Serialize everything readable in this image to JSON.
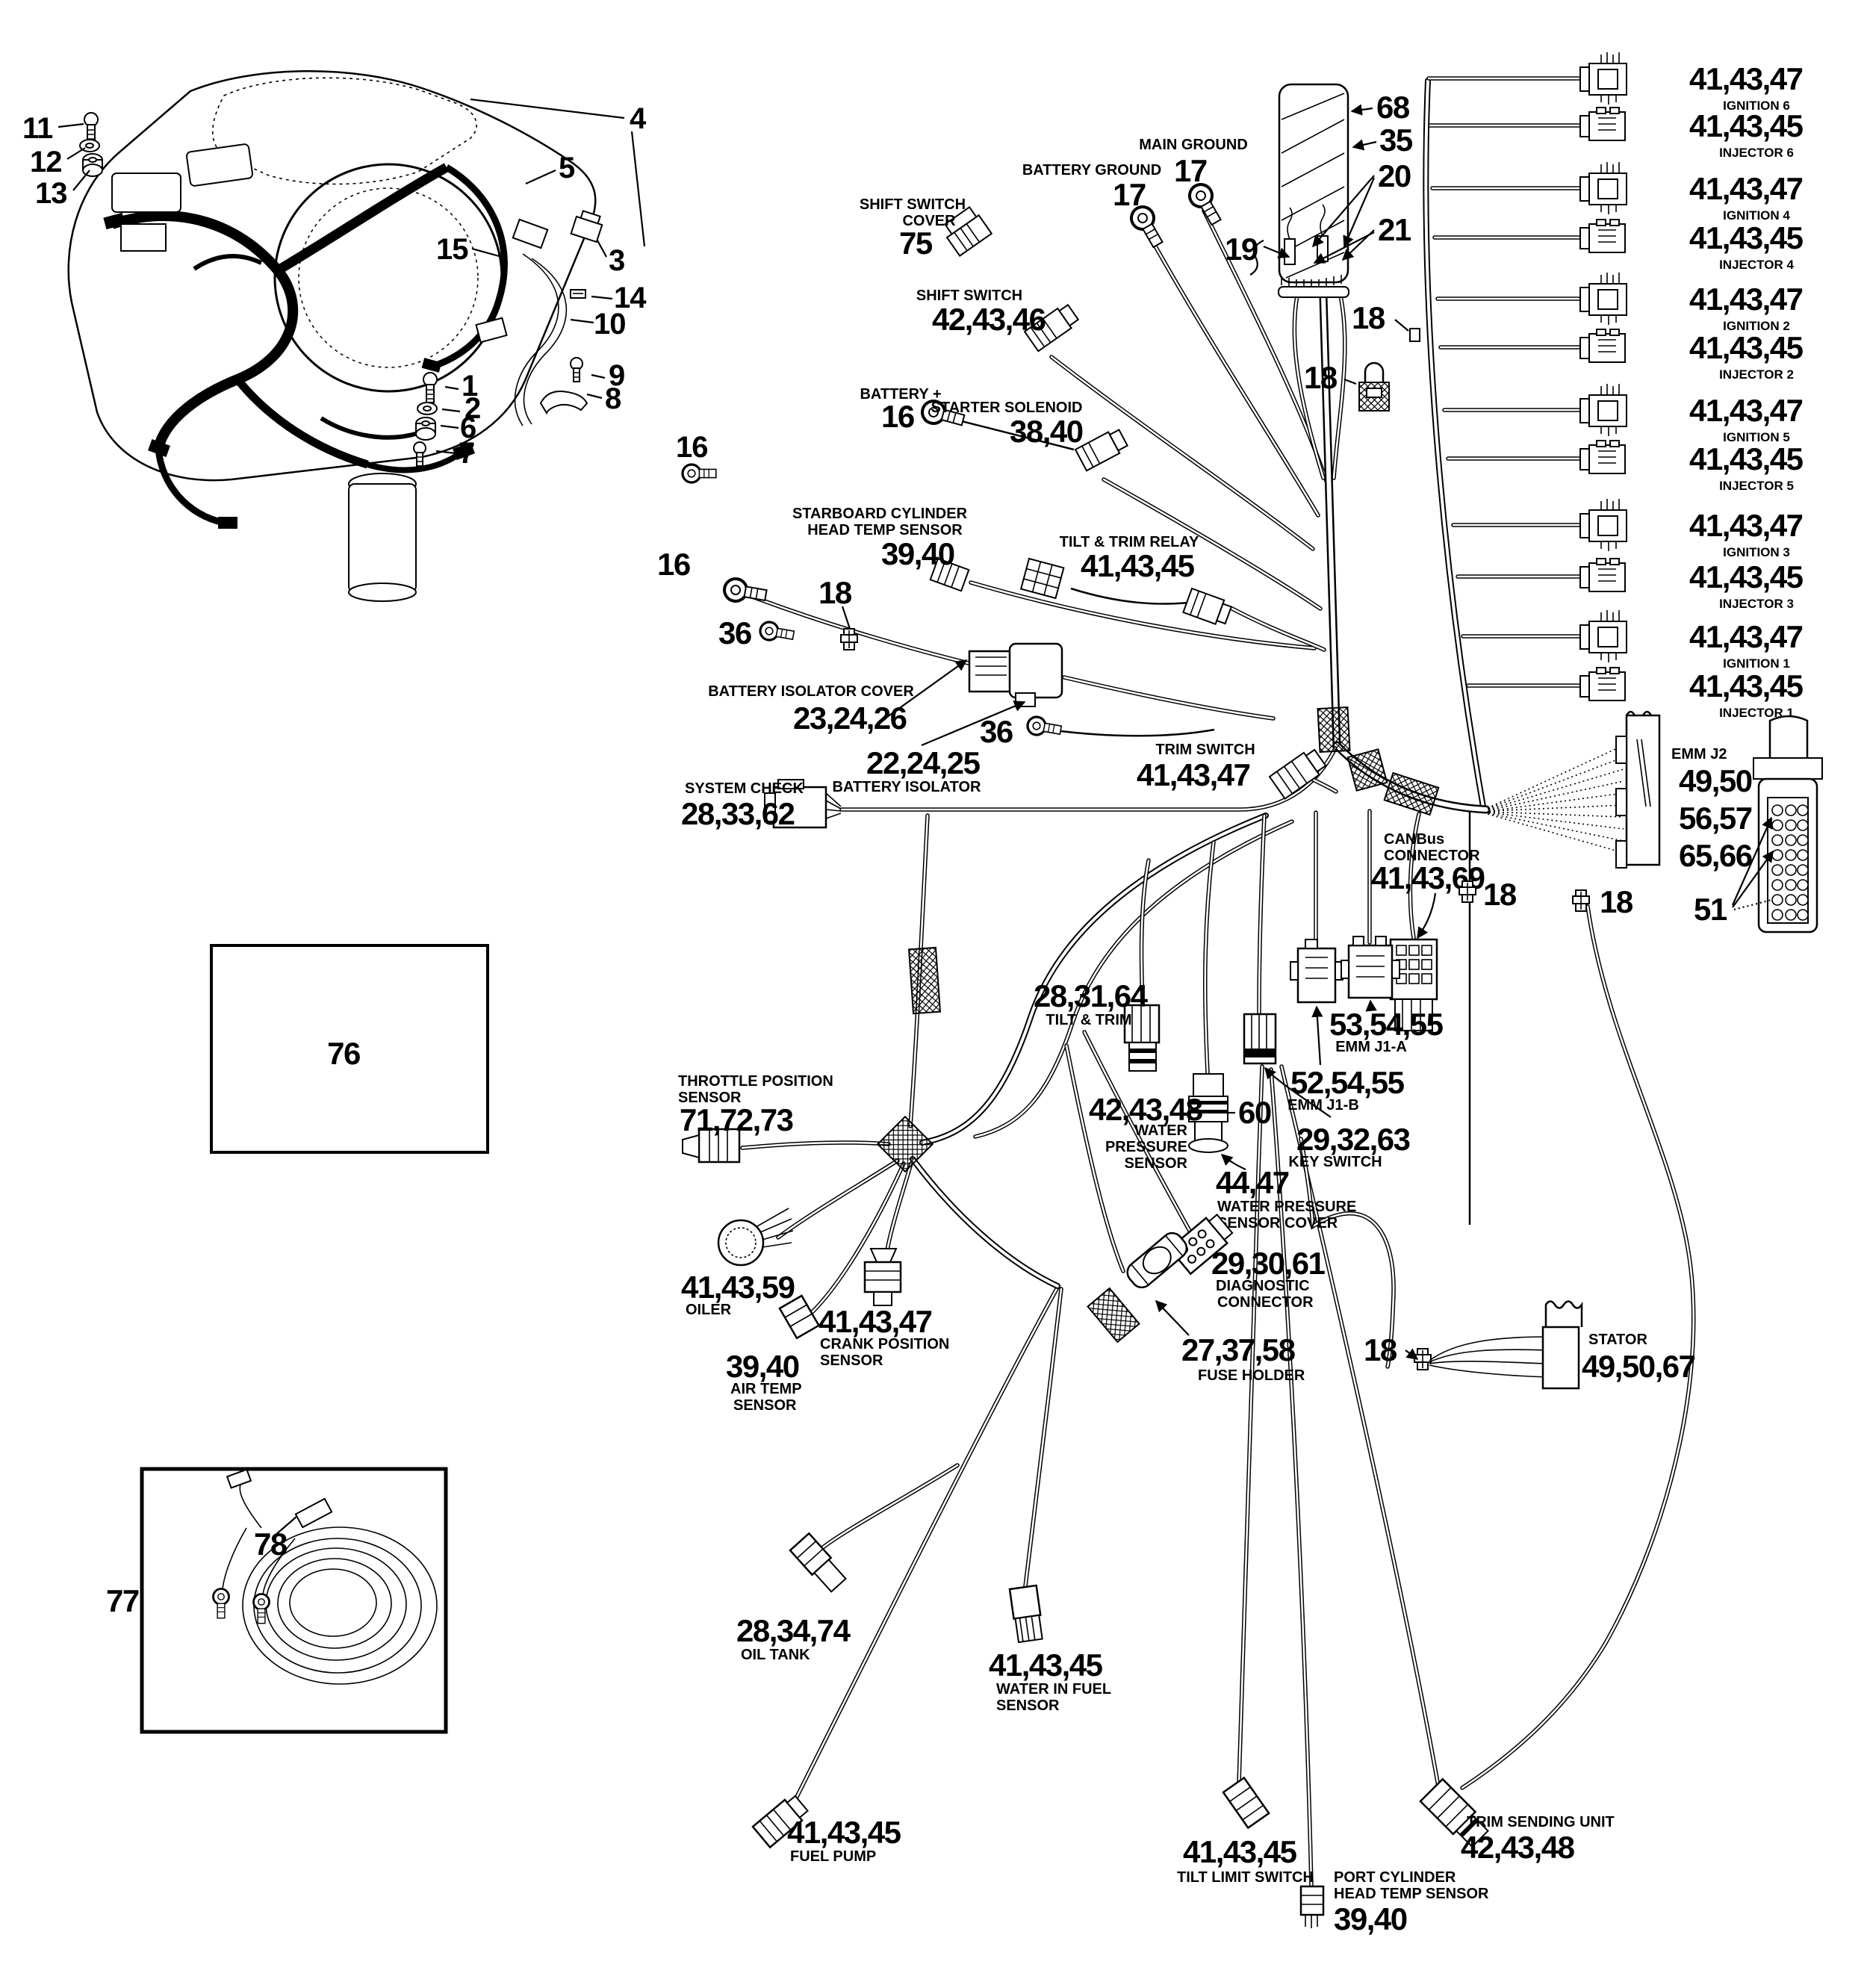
{
  "colors": {
    "ink": "#000000",
    "bg": "#ffffff"
  },
  "assembly_callouts": {
    "n11": "11",
    "n12": "12",
    "n13": "13",
    "n4": "4",
    "n5": "5",
    "n3": "3",
    "n14": "14",
    "n10": "10",
    "n15": "15",
    "n9": "9",
    "n8": "8",
    "n1": "1",
    "n2": "2",
    "n6": "6",
    "n7": "7",
    "n16": "16"
  },
  "relay_assembly": {
    "n68": "68",
    "n35": "35",
    "n20": "20",
    "n21": "21",
    "n19": "19",
    "n18edge": "18",
    "n18lock": "18"
  },
  "connector_column": [
    {
      "num": "41,43,47",
      "desc": "IGNITION 6"
    },
    {
      "num": "41,43,45",
      "desc": "INJECTOR 6"
    },
    {
      "num": "41,43,47",
      "desc": "IGNITION 4"
    },
    {
      "num": "41,43,45",
      "desc": "INJECTOR 4"
    },
    {
      "num": "41,43,47",
      "desc": "IGNITION 2"
    },
    {
      "num": "41,43,45",
      "desc": "INJECTOR 2"
    },
    {
      "num": "41,43,47",
      "desc": "IGNITION 5"
    },
    {
      "num": "41,43,45",
      "desc": "INJECTOR 5"
    },
    {
      "num": "41,43,47",
      "desc": "IGNITION 3"
    },
    {
      "num": "41,43,45",
      "desc": "INJECTOR 3"
    },
    {
      "num": "41,43,47",
      "desc": "IGNITION 1"
    },
    {
      "num": "41,43,45",
      "desc": "INJECTOR 1"
    }
  ],
  "components": {
    "main_ground": {
      "name": "MAIN GROUND",
      "num": "17"
    },
    "battery_ground": {
      "name": "BATTERY GROUND",
      "num": "17"
    },
    "shift_switch_cover": {
      "name": "SHIFT SWITCH",
      "name2": "COVER",
      "num": "75"
    },
    "shift_switch": {
      "name": "SHIFT SWITCH",
      "num": "42,43,46"
    },
    "battery_plus": {
      "name": "BATTERY +",
      "num": "16"
    },
    "starter_solenoid": {
      "name": "STARTER SOLENOID",
      "num": "38,40"
    },
    "stbd_head_temp": {
      "name": "STARBOARD CYLINDER",
      "name2": "HEAD TEMP SENSOR",
      "num": "39,40"
    },
    "tilt_trim_relay": {
      "name": "TILT & TRIM RELAY",
      "num": "41,43,45"
    },
    "ring16": {
      "num": "16"
    },
    "ring36a": {
      "num": "36"
    },
    "tie18a": {
      "num": "18"
    },
    "battery_isolator_cover": {
      "name": "BATTERY ISOLATOR COVER",
      "num": "23,24,26"
    },
    "battery_isolator": {
      "num": "22,24,25",
      "name": "BATTERY ISOLATOR"
    },
    "ring36b": {
      "num": "36"
    },
    "trim_switch": {
      "name": "TRIM SWITCH",
      "num": "41,43,47"
    },
    "system_check": {
      "name": "SYSTEM CHECK",
      "num": "28,33,62"
    },
    "emm_j2": {
      "name": "EMM J2",
      "num1": "49,50",
      "num2": "56,57",
      "num3": "65,66"
    },
    "tie18_j2": {
      "num": "18"
    },
    "pins51": {
      "num": "51"
    },
    "canbus": {
      "name": "CANBus",
      "name2": "CONNECTOR",
      "num": "41,43,69"
    },
    "tie18_canbus": {
      "num": "18"
    },
    "tilt_trim": {
      "num": "28,31,64",
      "name": "TILT & TRIM"
    },
    "emm_j1a": {
      "num": "53,54,55",
      "name": "EMM J1-A"
    },
    "emm_j1b": {
      "num": "52,54,55",
      "name": "EMM J1-B"
    },
    "key_switch": {
      "num": "29,32,63",
      "name": "KEY SWITCH"
    },
    "water_pressure_sensor": {
      "num": "42,43,48",
      "name": "WATER",
      "name2": "PRESSURE",
      "name3": "SENSOR"
    },
    "n60": {
      "num": "60"
    },
    "wps_cover": {
      "num": "44,47",
      "name": "WATER PRESSURE",
      "name2": "SENSOR COVER"
    },
    "diagnostic": {
      "num": "29,30,61",
      "name": "DIAGNOSTIC",
      "name2": "CONNECTOR"
    },
    "fuse_holder": {
      "num": "27,37,58",
      "name": "FUSE HOLDER"
    },
    "tps": {
      "name": "THROTTLE POSITION",
      "name2": "SENSOR",
      "num": "71,72,73"
    },
    "oiler": {
      "num": "41,43,59",
      "name": "OILER"
    },
    "crank": {
      "num": "41,43,47",
      "name": "CRANK POSITION",
      "name2": "SENSOR"
    },
    "air_temp": {
      "num": "39,40",
      "name": "AIR TEMP",
      "name2": "SENSOR"
    },
    "stator": {
      "tie": "18",
      "name": "STATOR",
      "num": "49,50,67"
    },
    "oil_tank": {
      "num": "28,34,74",
      "name": "OIL TANK"
    },
    "water_in_fuel": {
      "num": "41,43,45",
      "name": "WATER IN FUEL",
      "name2": "SENSOR"
    },
    "fuel_pump": {
      "num": "41,43,45",
      "name": "FUEL PUMP"
    },
    "tilt_limit": {
      "num": "41,43,45",
      "name": "TILT LIMIT SWITCH"
    },
    "port_head_temp": {
      "name": "PORT CYLINDER",
      "name2": "HEAD TEMP SENSOR",
      "num": "39,40"
    },
    "trim_sending": {
      "name": "TRIM SENDING UNIT",
      "num": "42,43,48"
    }
  },
  "insets": {
    "n76": "76",
    "n77": "77",
    "n78": "78"
  }
}
